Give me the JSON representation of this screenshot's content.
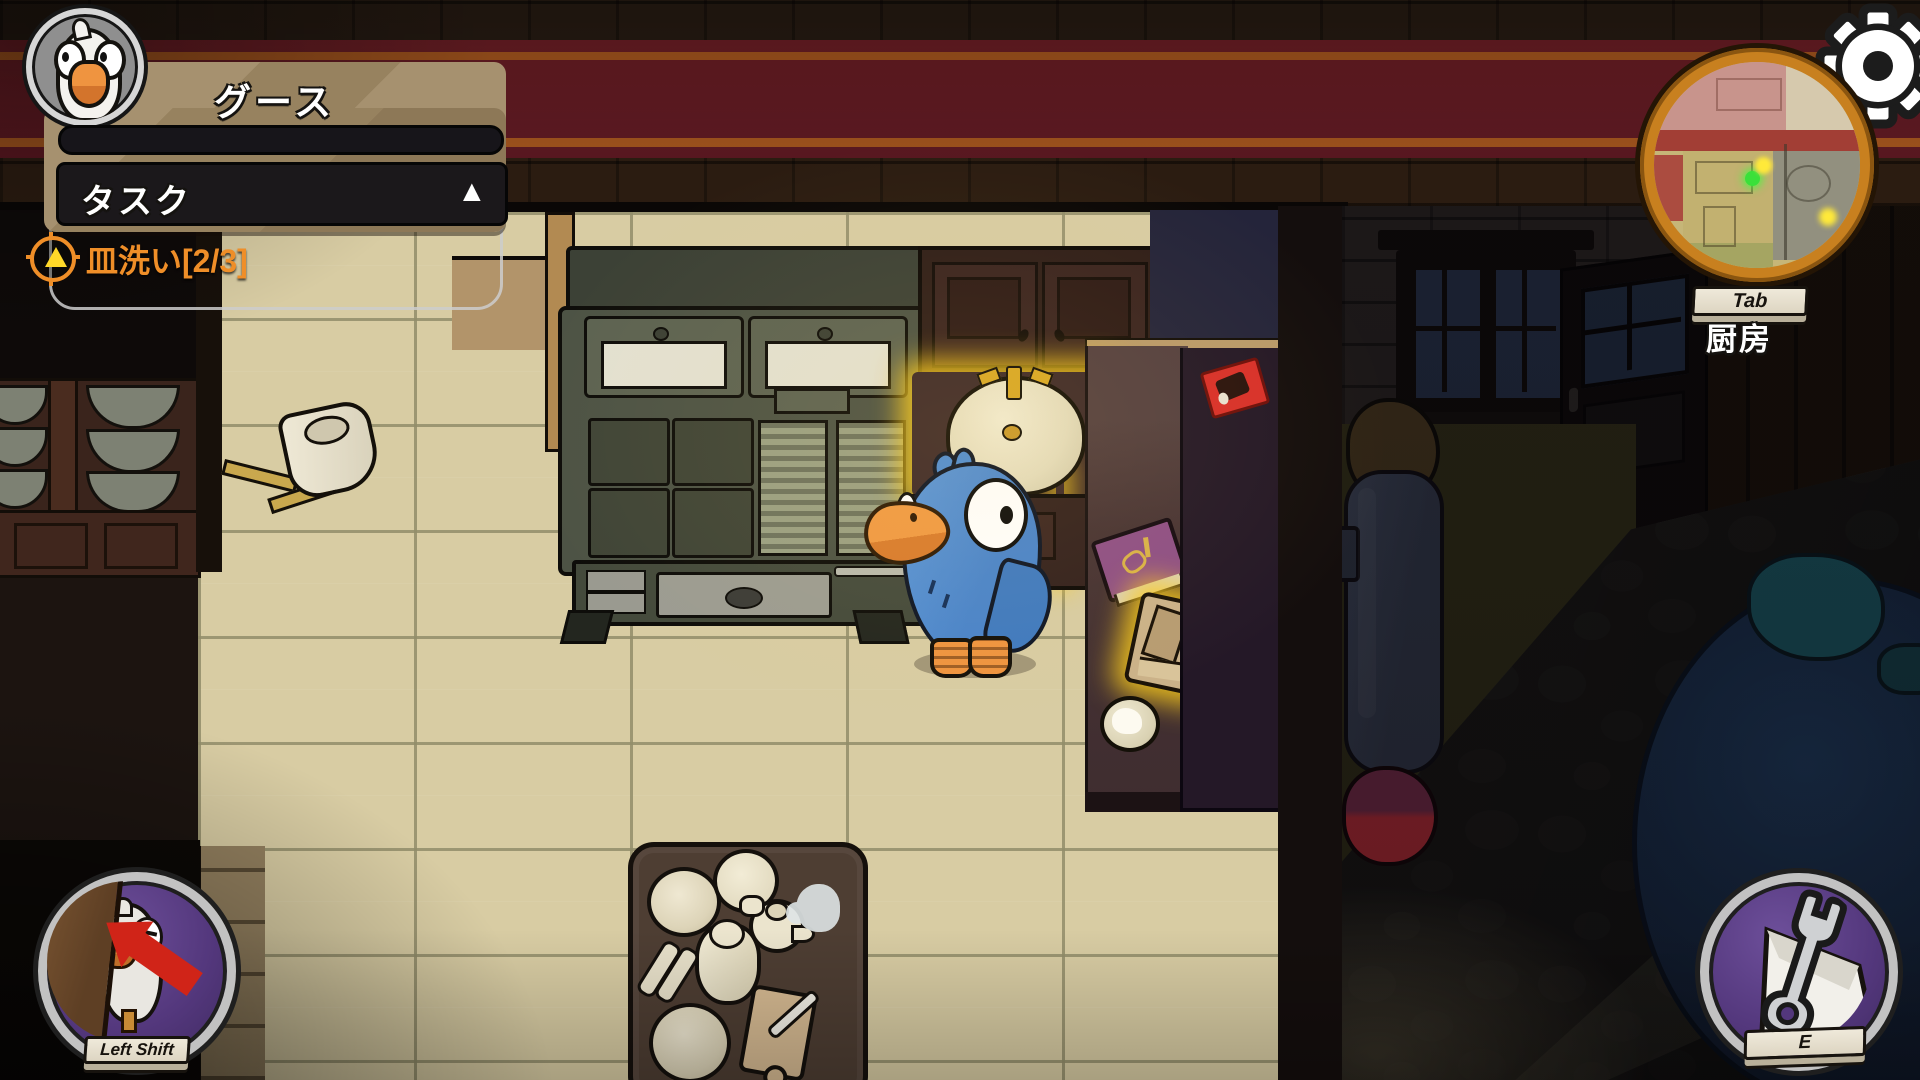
{
  "hud": {
    "player": {
      "name": "グース"
    },
    "progress": {
      "value": 0
    },
    "task_panel": {
      "title": "タスク",
      "collapse_icon": "▲"
    },
    "tasks": [
      {
        "label": "皿洗い",
        "count": "[2/3]"
      }
    ]
  },
  "minimap": {
    "key_hint": "Tab",
    "location": "厨房"
  },
  "actions": {
    "hide": {
      "key": "Left Shift"
    },
    "use": {
      "key": "E"
    }
  },
  "icons": {
    "settings": "gear-icon",
    "task_marker": "crosshair-triangle-icon",
    "hide_action": "goose-behind-door-icon",
    "use_action": "wrench-icon"
  },
  "colors": {
    "task_orange": "#ef8e28",
    "glow_yellow": "#fccd1c",
    "button_purple": "#5a3d85",
    "ring_silver": "#c2c2c2",
    "panel_tan": "#9b8768",
    "minimap_ring_orange": "#c8801f"
  }
}
